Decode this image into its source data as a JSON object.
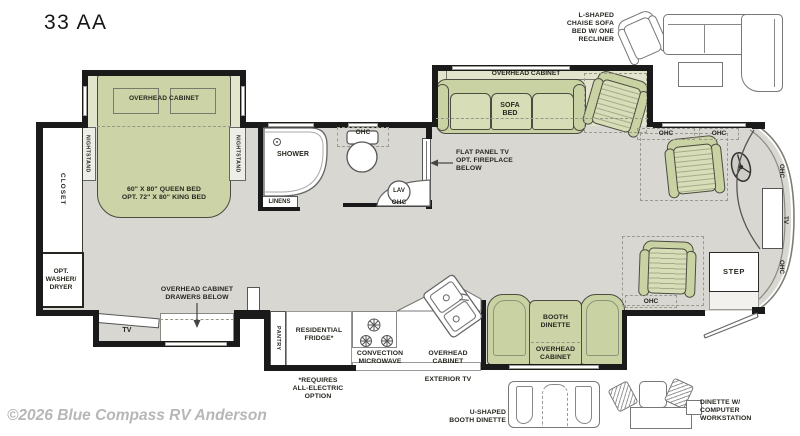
{
  "plan": {
    "title": "33 AA",
    "watermark": "©2026 Blue Compass RV Anderson"
  },
  "colors": {
    "furniture_green": "#c9d2a3",
    "slide_tint": "#e2e5cb",
    "floor": "#d9d7d2",
    "wall": "#1a1a1a",
    "watermark_gray": "#b7b7b7"
  },
  "bedroom": {
    "overhead_cabinet": "OVERHEAD CABINET",
    "nightstand_left": "NIGHTSTAND",
    "nightstand_right": "NIGHTSTAND",
    "bed": "60\" X 80\" QUEEN BED\nOPT. 72\" X 80\" KING BED",
    "closet": "CLOSET",
    "washer_dryer": "OPT.\nWASHER/\nDRYER",
    "tv": "TV",
    "dresser_note": "OVERHEAD CABINET\nDRAWERS BELOW"
  },
  "bathroom": {
    "shower": "SHOWER",
    "linens": "LINENS",
    "toilet_ohc": "OHC",
    "lav": "LAV",
    "lav_ohc": "OHC"
  },
  "living": {
    "overhead_cabinet": "OVERHEAD CABINET",
    "sofa_bed": "SOFA\nBED",
    "tv_note": "FLAT PANEL TV\nOPT. FIREPLACE\nBELOW"
  },
  "cockpit": {
    "ohc_1": "OHC",
    "ohc_2": "OHC",
    "front_ohc_top": "OHC",
    "front_tv": "TV",
    "front_ohc_bottom": "OHC",
    "step": "STEP",
    "ohc_entry": "OHC"
  },
  "kitchen": {
    "pantry": "PANTRY",
    "fridge": "RESIDENTIAL\nFRIDGE*",
    "microwave": "CONVECTION\nMICROWAVE",
    "overhead_cabinet": "OVERHEAD\nCABINET",
    "exterior_tv": "EXTERIOR TV",
    "note": "*REQUIRES\nALL-ELECTRIC\nOPTION"
  },
  "dinette": {
    "booth": "BOOTH\nDINETTE",
    "overhead_cabinet": "OVERHEAD\nCABINET"
  },
  "options": {
    "l_shaped": "L-SHAPED\nCHAISE SOFA\nBED W/ ONE\nRECLINER",
    "u_shaped": "U-SHAPED\nBOOTH DINETTE",
    "workstation": "DINETTE W/\nCOMPUTER\nWORKSTATION"
  }
}
